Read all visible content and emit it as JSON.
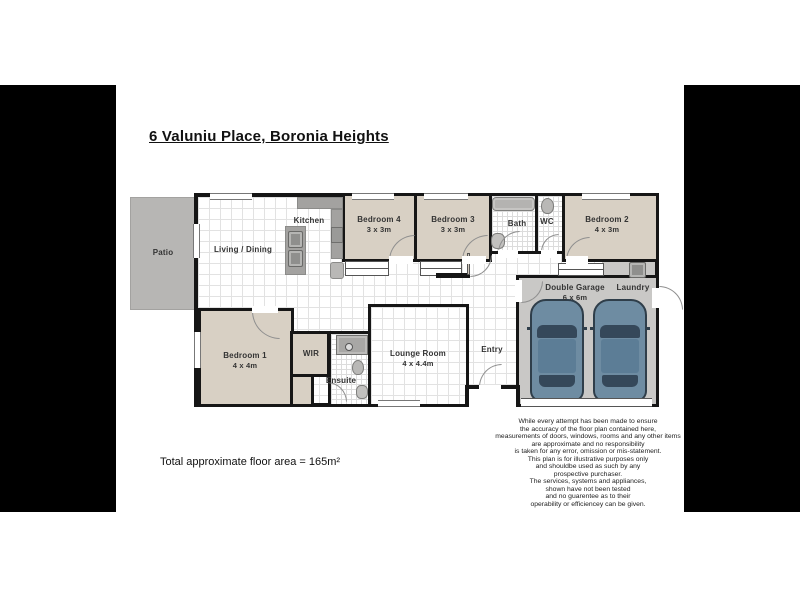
{
  "title": "6 Valuniu Place, Boronia Heights",
  "rooms": {
    "patio": {
      "name": "Patio"
    },
    "living": {
      "name": "Living / Dining"
    },
    "kitchen": {
      "name": "Kitchen"
    },
    "bedroom4": {
      "name": "Bedroom 4",
      "dims": "3 x 3m"
    },
    "bedroom3": {
      "name": "Bedroom 3",
      "dims": "3 x 3m"
    },
    "bath": {
      "name": "Bath"
    },
    "wc": {
      "name": "WC"
    },
    "bedroom2": {
      "name": "Bedroom 2",
      "dims": "4 x 3m"
    },
    "garage": {
      "name": "Double Garage",
      "dims": "6 x 6m"
    },
    "laundry": {
      "name": "Laundry"
    },
    "bedroom1": {
      "name": "Bedroom 1",
      "dims": "4 x 4m"
    },
    "wir": {
      "name": "WIR"
    },
    "ensuite": {
      "name": "Ensuite"
    },
    "lounge": {
      "name": "Lounge Room",
      "dims": "4 x 4.4m"
    },
    "entry": {
      "name": "Entry"
    }
  },
  "footer": {
    "floor_area": "Total approximate floor area = 165m²"
  },
  "disclaimer": {
    "lines": [
      "While every attempt has been made to ensure",
      "the accuracy of the floor plan contained here,",
      "measurements of doors, windows, rooms and any other items",
      "are approximate and no responsibility",
      "is taken for any error, omission or mis-statement.",
      "This plan is for illustrative purposes only",
      "and shouldbe used as such by any",
      "prospective purchaser.",
      "The services, systems and appliances,",
      "shown have not been tested",
      "and no guarentee as to their",
      "operability or efficiencey can be given."
    ]
  },
  "colors": {
    "wall": "#161616",
    "room_fill": "#d8d0c4",
    "patio": "#b7b6b4",
    "garage_floor": "#c9c8c6",
    "car_body": "#6e8ca2",
    "letterbox": "#000000"
  }
}
